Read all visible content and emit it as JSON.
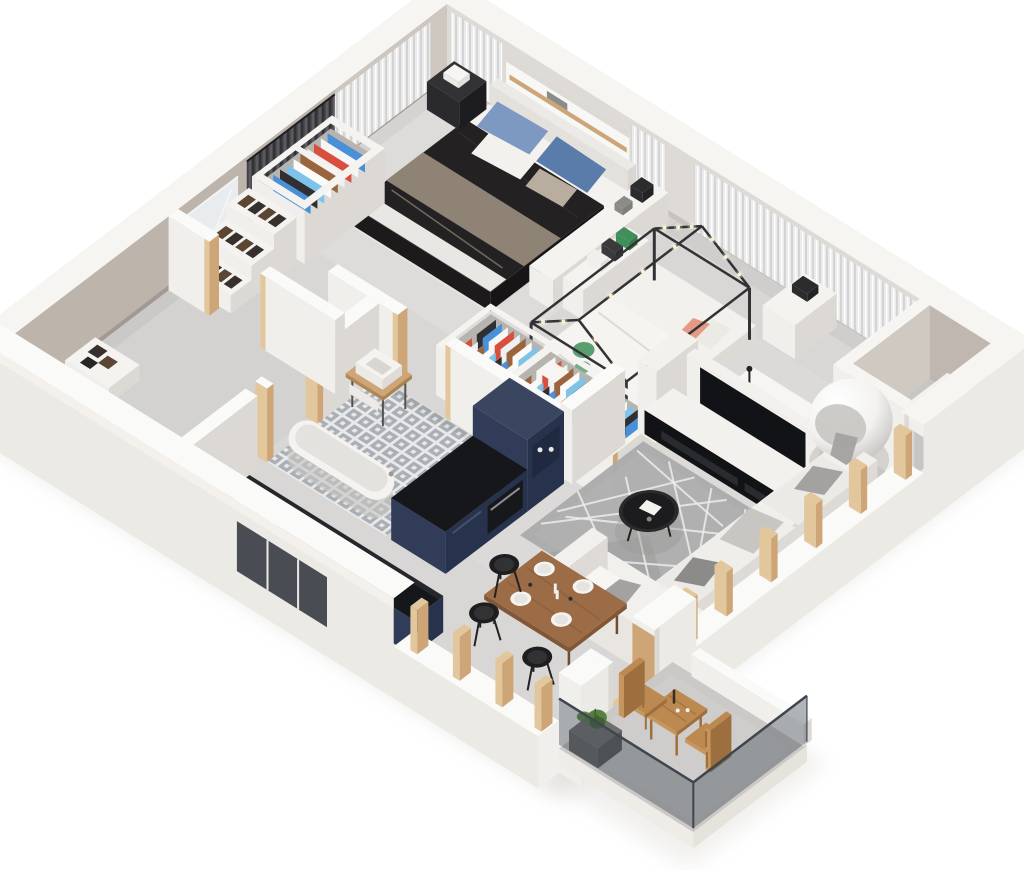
{
  "scene": {
    "title": "3D isometric apartment floor plan cutaway render",
    "style": "photoreal isometric dollhouse view, no text labels"
  },
  "rooms": [
    {
      "name": "bedroom"
    },
    {
      "name": "kids-room"
    },
    {
      "name": "walk-in-closet"
    },
    {
      "name": "entry-hall"
    },
    {
      "name": "bathroom"
    },
    {
      "name": "kitchen"
    },
    {
      "name": "dining-area"
    },
    {
      "name": "living-room"
    },
    {
      "name": "balcony"
    }
  ],
  "furniture": [
    "ground-shadow",
    "floor-slab",
    "back-right-wall",
    "bedroom-window-niche",
    "back-left-wall",
    "wall-mirror",
    "sheer-curtains",
    "dark-curtain",
    "corner-niche",
    "bedroom-bed",
    "nightstand",
    "bedroom-bench",
    "kids-dresser",
    "kids-bookshelf",
    "kids-house-bed",
    "study-desk",
    "yellow-chair",
    "closet-clothes-unit",
    "closet-shoe-shelves",
    "kids-wardrobe",
    "interior-walls",
    "bathroom-tile-floor",
    "bathroom-vanity",
    "bathtub",
    "kitchen-tall-units",
    "entry-shoe-shelf",
    "tv-unit",
    "living-rug",
    "coffee-table",
    "ball-chair",
    "sofa",
    "kitchen-counter",
    "dining-table",
    "dining-stools",
    "front-left-wall",
    "front-right-wall",
    "balcony-floor",
    "balcony-table",
    "balcony-chairs",
    "balcony-planter",
    "balcony-glass-railing"
  ],
  "colors": {
    "background": "#ffffff",
    "shadow_soft": "#dcd9d5",
    "wall_top": "#f6f5f2",
    "wall_top_bright": "#fafaf8",
    "wall_outer_face": "#eceae5",
    "wall_inner_light": "#dedbd7",
    "wall_inner_greige": "#bdb4ac",
    "wall_white_face": "#f1efec",
    "wall_white_side": "#dcd8d3",
    "wood": "#cda576",
    "wood_light": "#e3c79c",
    "floor": "#d8d7d5",
    "floor_light": "#e3e2e0",
    "floor_dark": "#c7c6c4",
    "tile_bg": "#e9e9ea",
    "tile_fg": "#9aa0a8",
    "curtain_light": "#ececec",
    "curtain_mid": "#d4d4d4",
    "curtain_dark": "#47474b",
    "curtain_darker": "#2e2e31",
    "mirror": "#e9ecee",
    "bed_frame": "#eceae6",
    "blanket_dark": "#242122",
    "blanket_taupe": "#8f8376",
    "sheet_white": "#f4f2ee",
    "pillow_blue": "#7e99c1",
    "pillow_blue_dark": "#5a7cab",
    "nightstand": "#2a2a2c",
    "kids_frame": "#333335",
    "lights": "#fff6dc",
    "bedding_white": "#f3f1ed",
    "print_green": "#3f8f5b",
    "pillow_salmon": "#e59a86",
    "unit_white": "#f4f3f0",
    "unit_inner": "#b7b3ae",
    "clothes": [
      "#4a90d9",
      "#f6f6f6",
      "#d94f3d",
      "#eff0f2",
      "#9a653c",
      "#fbfbfa",
      "#7ec3e8",
      "#303032"
    ],
    "shoes": "#38302c",
    "shoes_brown": "#5a4632",
    "desk": "#f6f5f3",
    "chair_yellow": "#f1c11f",
    "chair_yellow_dark": "#d9a916",
    "kitchen_navy": "#303c58",
    "kitchen_navy_dark": "#27334d",
    "counter_dark": "#16171b",
    "sink_white": "#f2f2f0",
    "dining_wood": "#9b6c45",
    "dining_wood_dark": "#815737",
    "stool": "#1e1e20",
    "plate": "#f5f4f1",
    "tv_unit": "#f3f1ee",
    "tv_black": "#121316",
    "rug": "#ababab",
    "rug_lines": "#ececec",
    "coffee_table": "#2a2a2c",
    "sofa": "#f1f0ed",
    "sofa_shadow": "#dddad5",
    "cushion": "#a3a2a0",
    "cushion_dark": "#8c8b89",
    "ball_chair": "#f3f2f0",
    "ball_shadow": "#bcbab7",
    "balcony_wood": "#bc8951",
    "balcony_wood_dark": "#9e6f3e",
    "glass": "rgba(62,72,82,0.40)",
    "glass_edge": "#3f464e",
    "plant": "#4d7c3a",
    "plant_dark": "#3c6130",
    "planter": "#6f6f6c"
  }
}
